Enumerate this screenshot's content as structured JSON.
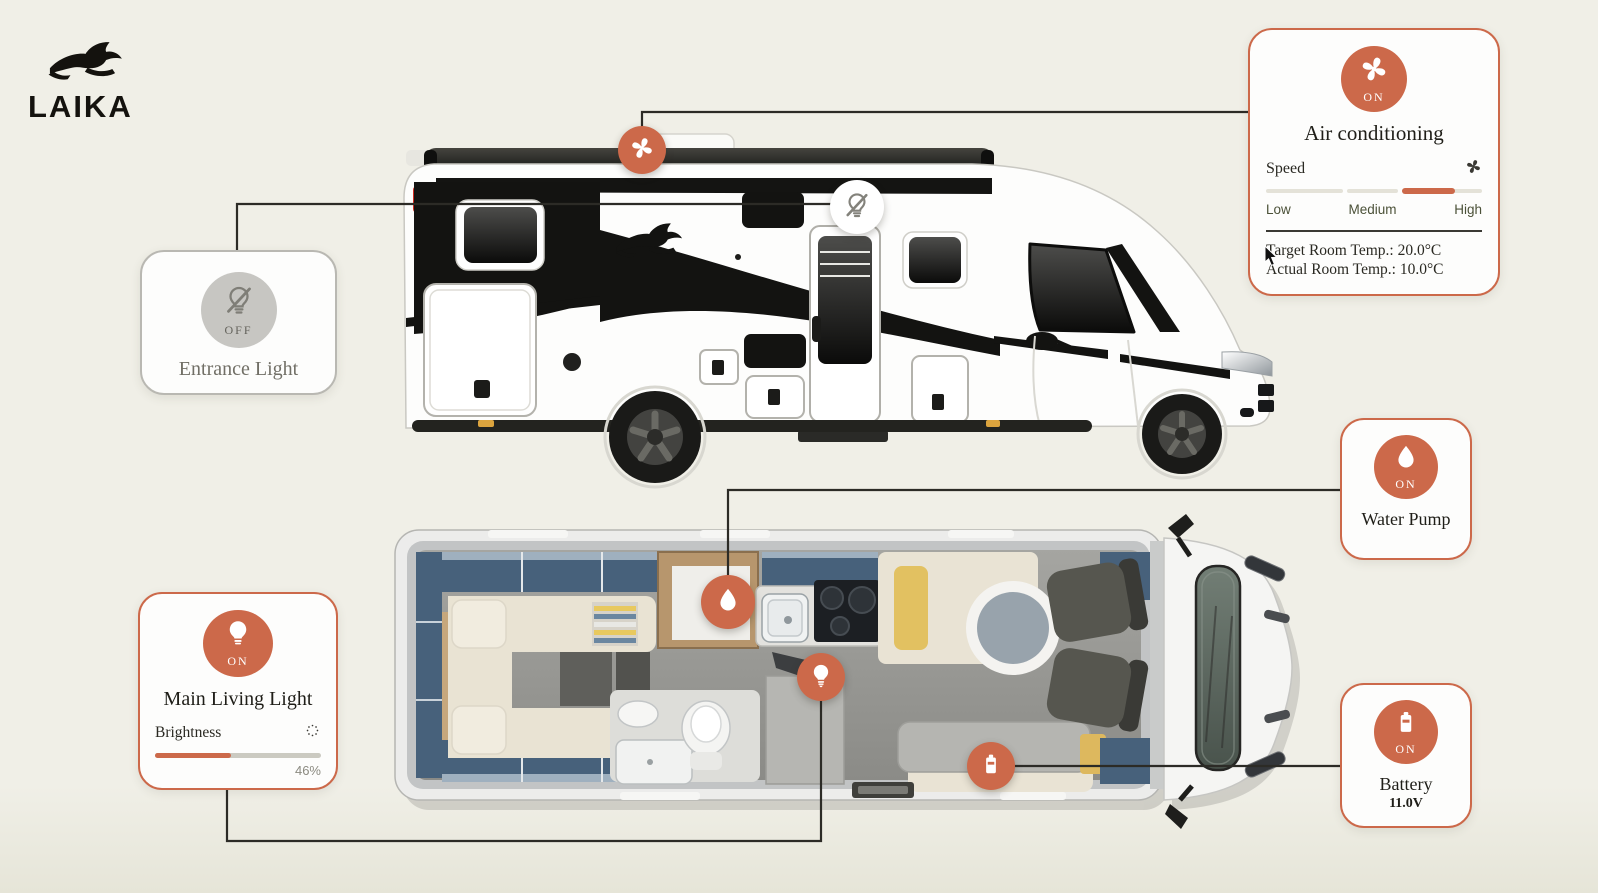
{
  "brand": {
    "name": "LAIKA"
  },
  "colors": {
    "accent": "#cc694a",
    "background": "#f0efe7",
    "off_gray": "#c7c6c2",
    "text_dark": "#1f1e18",
    "slider_label": "#4b5138"
  },
  "cards": {
    "air_conditioning": {
      "status": "ON",
      "title": "Air conditioning",
      "speed": {
        "label": "Speed",
        "options": [
          "Low",
          "Medium",
          "High"
        ],
        "selected": "Medium",
        "fill_start_percent": 63,
        "fill_end_percent": 87.5
      },
      "target_temp": {
        "label": "Target Room Temp.:",
        "value": "20.0°C"
      },
      "actual_temp": {
        "label": "Actual Room Temp.:",
        "value": "10.0°C"
      }
    },
    "entrance_light": {
      "status": "OFF",
      "title": "Entrance Light"
    },
    "main_living_light": {
      "status": "ON",
      "title": "Main Living Light",
      "brightness_label": "Brightness",
      "brightness_percent": 46,
      "brightness_display": "46%"
    },
    "water_pump": {
      "status": "ON",
      "title": "Water Pump"
    },
    "battery": {
      "status": "ON",
      "title": "Battery",
      "voltage": "11.0V"
    }
  },
  "markers": {
    "air_conditioning": {
      "icon": "fan-icon",
      "state": "on"
    },
    "entrance_light": {
      "icon": "bulb-slash-icon",
      "state": "off"
    },
    "water_pump": {
      "icon": "water-drop-icon",
      "state": "on"
    },
    "main_living_light": {
      "icon": "bulb-icon",
      "state": "on"
    },
    "battery": {
      "icon": "battery-icon",
      "state": "on"
    }
  }
}
